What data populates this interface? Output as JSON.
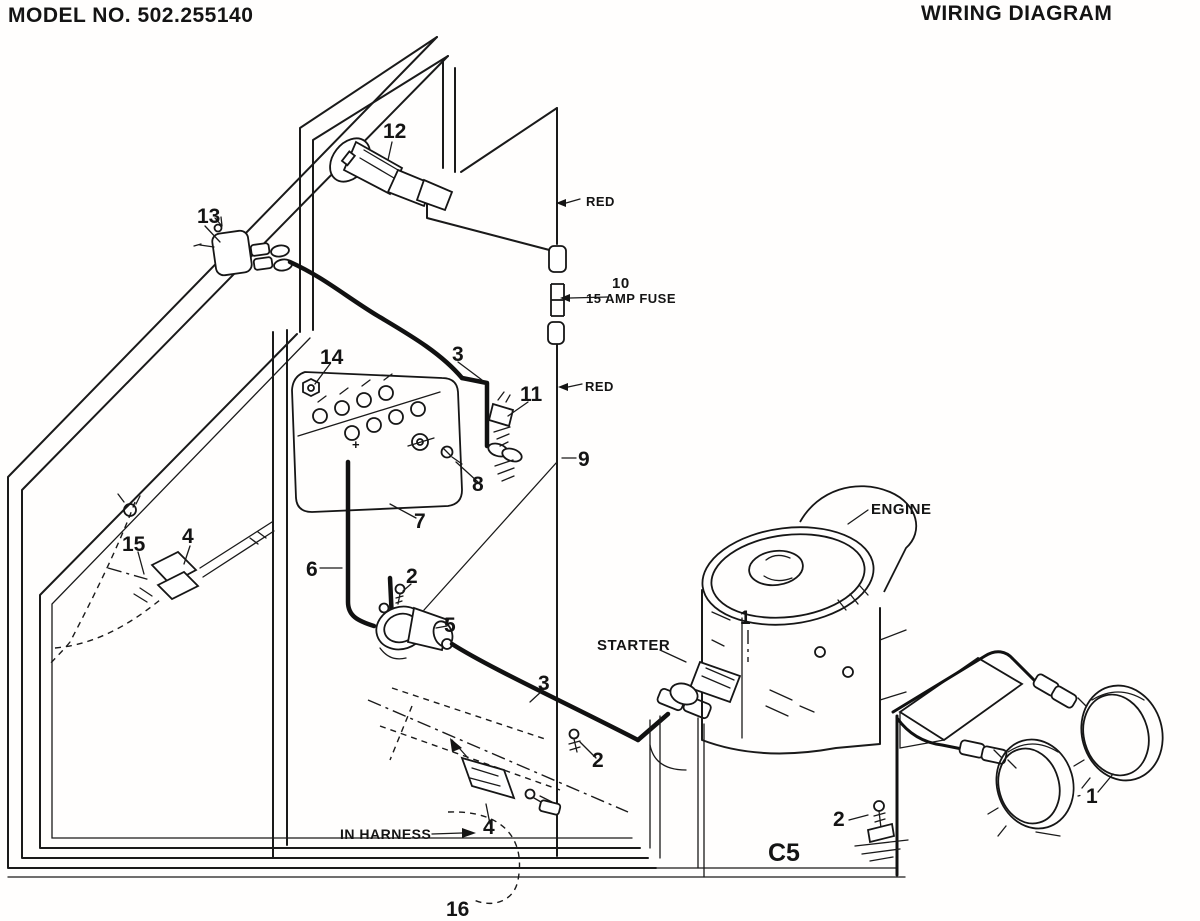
{
  "header": {
    "model_no": "MODEL NO. 502.255140",
    "title": "WIRING DIAGRAM"
  },
  "labels": {
    "n1": "1",
    "n2": "2",
    "n3": "3",
    "n4": "4",
    "n5": "5",
    "n6": "6",
    "n7": "7",
    "n8": "8",
    "n9": "9",
    "n10": "10",
    "n11": "11",
    "n12": "12",
    "n13": "13",
    "n14": "14",
    "n15": "15",
    "n16": "16",
    "red": "RED",
    "fuse": "15 AMP FUSE",
    "engine": "ENGINE",
    "starter": "STARTER",
    "in_harness": "IN HARNESS",
    "c5": "C5",
    "battery_plus": "+"
  }
}
